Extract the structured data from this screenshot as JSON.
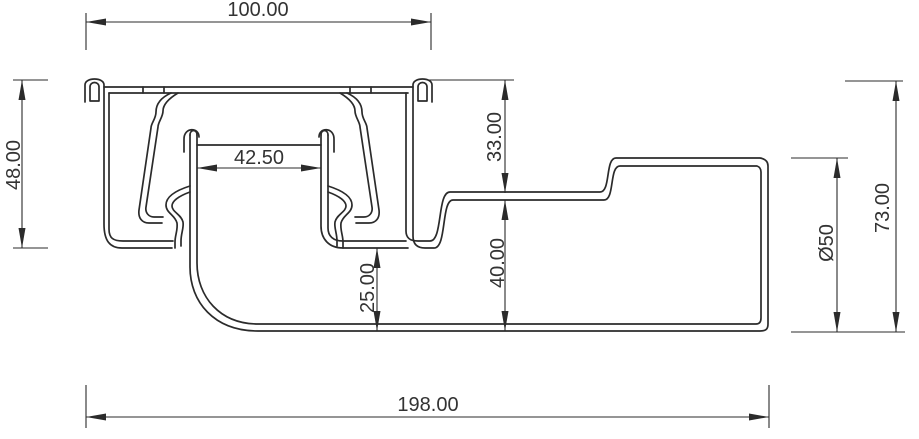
{
  "drawing": {
    "background_color": "#ffffff",
    "line_color": "#2b2b2b",
    "text_color": "#333333",
    "type_note": "technical cross-section drawing of a floor drain with side outlet",
    "dimensions": {
      "flange_width": {
        "label": "100.00"
      },
      "body_height": {
        "label": "48.00"
      },
      "inner_tube_width": {
        "label": "42.50"
      },
      "flange_to_outlet_top": {
        "label": "33.00"
      },
      "outlet_top_to_bottom": {
        "label": "40.00"
      },
      "trap_to_bottom": {
        "label": "25.00"
      },
      "outlet_diameter": {
        "label": "Ø50"
      },
      "overall_height": {
        "label": "73.00"
      },
      "overall_length": {
        "label": "198.00"
      }
    }
  }
}
